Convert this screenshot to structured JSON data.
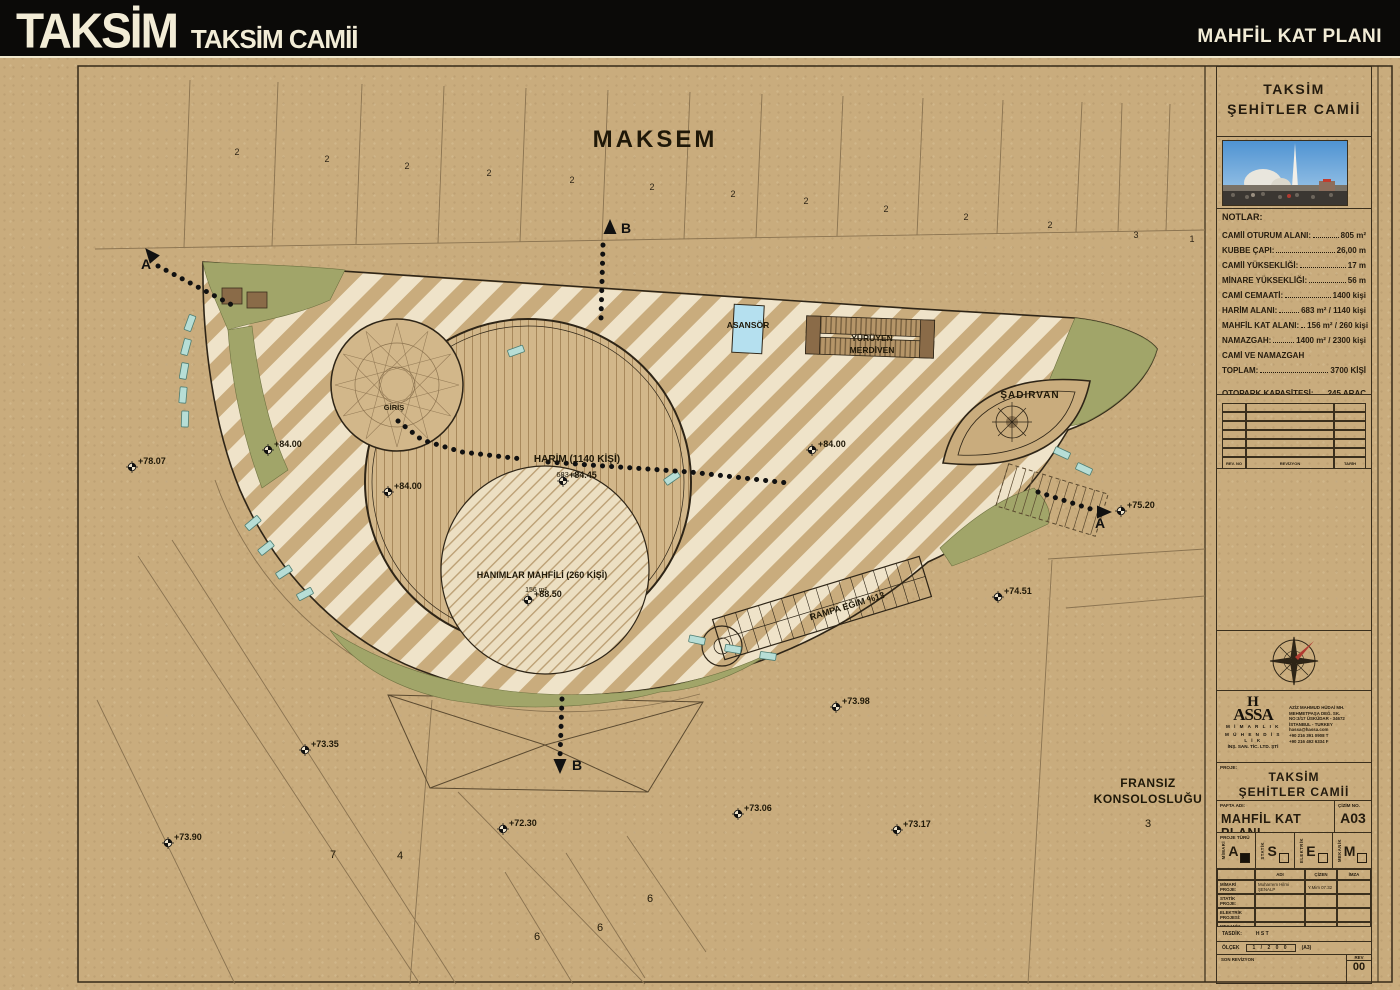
{
  "header": {
    "logo": "TAKSİM",
    "logo_sub": "TAKSİM CAMİİ",
    "sheet_title": "MAHFİL KAT PLANI"
  },
  "plan": {
    "labels": [
      {
        "t": "MAKSEM",
        "x": 655,
        "y": 147,
        "s": 24,
        "w": 600,
        "ls": 3
      },
      {
        "t": "ASANSÖR",
        "x": 748,
        "y": 328,
        "s": 8.5,
        "w": 700
      },
      {
        "t": "YÜRÜYEN",
        "x": 872,
        "y": 341,
        "s": 8.5,
        "w": 700
      },
      {
        "t": "MERDİVEN",
        "x": 872,
        "y": 353,
        "s": 8.5,
        "w": 700
      },
      {
        "t": "ŞADIRVAN",
        "x": 1030,
        "y": 398,
        "s": 10,
        "w": 700,
        "ls": 1
      },
      {
        "t": "GİRİŞ",
        "x": 394,
        "y": 410,
        "s": 7.5,
        "w": 700
      },
      {
        "t": "HARİM (1140 KİŞİ)",
        "x": 577,
        "y": 462,
        "s": 10,
        "w": 700
      },
      {
        "t": "683 m²",
        "x": 568,
        "y": 477,
        "s": 7.5,
        "w": 400
      },
      {
        "t": "HANIMLAR MAHFİLİ (260 KİŞİ)",
        "x": 542,
        "y": 578,
        "s": 9,
        "w": 700
      },
      {
        "t": "156 m²",
        "x": 536,
        "y": 592,
        "s": 7,
        "w": 400
      },
      {
        "t": "RAMPA EĞİM %13",
        "x": 848,
        "y": 609,
        "s": 9,
        "w": 700,
        "r": -17
      },
      {
        "t": "FRANSIZ",
        "x": 1148,
        "y": 787,
        "s": 12,
        "w": 600,
        "ls": 0.5
      },
      {
        "t": "KONSOLOSLUĞU",
        "x": 1148,
        "y": 803,
        "s": 12,
        "w": 600,
        "ls": 0.5
      },
      {
        "t": "3",
        "x": 1148,
        "y": 827,
        "s": 11,
        "w": 400
      },
      {
        "t": "7",
        "x": 333,
        "y": 858,
        "s": 11,
        "w": 400
      },
      {
        "t": "4",
        "x": 400,
        "y": 859,
        "s": 11,
        "w": 400
      },
      {
        "t": "6",
        "x": 537,
        "y": 940,
        "s": 11,
        "w": 400
      },
      {
        "t": "6",
        "x": 600,
        "y": 931,
        "s": 11,
        "w": 400
      },
      {
        "t": "6",
        "x": 650,
        "y": 902,
        "s": 11,
        "w": 400
      }
    ],
    "parcel_numbers": [
      {
        "t": "2",
        "x": 237,
        "y": 155
      },
      {
        "t": "2",
        "x": 327,
        "y": 162
      },
      {
        "t": "2",
        "x": 407,
        "y": 169
      },
      {
        "t": "2",
        "x": 489,
        "y": 176
      },
      {
        "t": "2",
        "x": 572,
        "y": 183
      },
      {
        "t": "2",
        "x": 652,
        "y": 190
      },
      {
        "t": "2",
        "x": 733,
        "y": 197
      },
      {
        "t": "2",
        "x": 806,
        "y": 204
      },
      {
        "t": "2",
        "x": 886,
        "y": 212
      },
      {
        "t": "2",
        "x": 966,
        "y": 220
      },
      {
        "t": "2",
        "x": 1050,
        "y": 228
      },
      {
        "t": "3",
        "x": 1136,
        "y": 238
      },
      {
        "t": "1",
        "x": 1192,
        "y": 242
      }
    ],
    "elevations": [
      {
        "x": 132,
        "y": 467,
        "v": "+78.07"
      },
      {
        "x": 268,
        "y": 450,
        "v": "+84.00"
      },
      {
        "x": 388,
        "y": 492,
        "v": "+84.00"
      },
      {
        "x": 563,
        "y": 481,
        "v": "+84.45"
      },
      {
        "x": 812,
        "y": 450,
        "v": "+84.00"
      },
      {
        "x": 528,
        "y": 600,
        "v": "+88.50"
      },
      {
        "x": 1121,
        "y": 511,
        "v": "+75.20"
      },
      {
        "x": 998,
        "y": 597,
        "v": "+74.51"
      },
      {
        "x": 836,
        "y": 707,
        "v": "+73.98"
      },
      {
        "x": 305,
        "y": 750,
        "v": "+73.35"
      },
      {
        "x": 168,
        "y": 843,
        "v": "+73.90"
      },
      {
        "x": 503,
        "y": 829,
        "v": "+72.30"
      },
      {
        "x": 738,
        "y": 814,
        "v": "+73.06"
      },
      {
        "x": 897,
        "y": 830,
        "v": "+73.17"
      }
    ],
    "sections": [
      {
        "l": "A",
        "x": 151,
        "y": 255,
        "a": -40,
        "lx": -10,
        "ly": 14
      },
      {
        "l": "B",
        "x": 610,
        "y": 228,
        "a": 0,
        "lx": 11,
        "ly": 5
      },
      {
        "l": "A",
        "x": 1103,
        "y": 512,
        "a": 90,
        "lx": -8,
        "ly": 16
      },
      {
        "l": "B",
        "x": 560,
        "y": 765,
        "a": 180,
        "lx": 12,
        "ly": 5
      }
    ],
    "dotted_paths": [
      [
        [
          158,
          266
        ],
        [
          232,
          305
        ]
      ],
      [
        [
          603,
          245
        ],
        [
          601,
          318
        ]
      ],
      [
        [
          398,
          421
        ],
        [
          422,
          440
        ],
        [
          462,
          452
        ],
        [
          522,
          459
        ]
      ],
      [
        [
          548,
          462
        ],
        [
          690,
          472
        ],
        [
          788,
          483
        ]
      ],
      [
        [
          562,
          699
        ],
        [
          560,
          757
        ]
      ],
      [
        [
          1038,
          492
        ],
        [
          1097,
          511
        ]
      ]
    ],
    "benches": [
      [
        190,
        323,
        -70
      ],
      [
        186,
        347,
        -75
      ],
      [
        184,
        371,
        -80
      ],
      [
        183,
        395,
        -85
      ],
      [
        185,
        419,
        -88
      ],
      [
        253,
        523,
        -40
      ],
      [
        266,
        548,
        -38
      ],
      [
        284,
        572,
        -33
      ],
      [
        305,
        594,
        -28
      ],
      [
        697,
        640,
        12
      ],
      [
        733,
        649,
        10
      ],
      [
        768,
        656,
        8
      ],
      [
        1062,
        453,
        25
      ],
      [
        1084,
        469,
        25
      ],
      [
        516,
        351,
        -20
      ],
      [
        672,
        478,
        -35
      ]
    ]
  },
  "sidebar": {
    "project_title": [
      "TAKSİM",
      "ŞEHİTLER CAMİİ"
    ],
    "notes_title": "NOTLAR:",
    "notes": [
      {
        "label": "CAMİİ OTURUM ALANI:",
        "value": "805 m²"
      },
      {
        "label": "KUBBE ÇAPI:",
        "value": "26,00 m"
      },
      {
        "label": "CAMİİ YÜKSEKLİĞİ:",
        "value": "17 m"
      },
      {
        "label": "MİNARE YÜKSEKLİĞİ:",
        "value": "56 m"
      },
      {
        "label": "CAMİ CEMAATİ:",
        "value": "1400 kişi"
      },
      {
        "label": "HARİM ALANI:",
        "value": "683 m² / 1140 kişi"
      },
      {
        "label": "MAHFİL KAT ALANI:",
        "value": "156 m² / 260 kişi"
      },
      {
        "label": "NAMAZGAH:",
        "value": "1400 m² / 2300 kişi"
      },
      {
        "label": "CAMİ VE NAMAZGAH",
        "label2": "TOPLAM:",
        "value": "3700 KİŞİ"
      },
      {
        "label": "OTOPARK KAPASİTESİ:",
        "value": "245 ARAÇ",
        "gap": true
      }
    ],
    "revision_table": {
      "headers": [
        "REV. NO",
        "REVİZYON",
        "TARİH"
      ],
      "empty_rows": 6
    },
    "firm": {
      "name_top": "H",
      "name_bottom": "ASSA",
      "lines": [
        "M İ M A R L I K",
        "M Ü H E N D İ S L İ K",
        "İNŞ. SAN. TİC. LTD. ŞTİ"
      ],
      "address": [
        "AZİZ MAHMUD HÜDAİ MH.",
        "MEHMETPAŞA DEĞ. SK.",
        "NO:3/17 ÜSKÜDAR - 34672",
        "İSTANBUL - TURKEY",
        "hassa@hassa.com",
        "+90 216 391 0908 T",
        "+90 216 492 6334 F"
      ]
    },
    "project_label": "PROJE:",
    "sheet": {
      "pafta_label": "PAFTA ADI:",
      "pafta_name": "MAHFİL KAT PLANI",
      "no_label": "ÇİZİM NO.",
      "no": "A03"
    },
    "types_label": "PROJE TÜRÜ",
    "types": [
      {
        "letter": "A",
        "name": "MİMARİ",
        "checked": true
      },
      {
        "letter": "S",
        "name": "STATİK",
        "checked": false
      },
      {
        "letter": "E",
        "name": "ELEKTRİK",
        "checked": false
      },
      {
        "letter": "M",
        "name": "MEKANİK",
        "checked": false
      }
    ],
    "staff": {
      "headers": [
        "",
        "ADI",
        "ÇİZEN",
        "İMZA"
      ],
      "rows": [
        {
          "label": "MİMARİ PROJE:",
          "name": "Muharrem Hilmi ŞENALP",
          "extra": "Y.Mim 07.32"
        },
        {
          "label": "STATİK PROJE:",
          "name": "",
          "extra": ""
        },
        {
          "label": "ELEKTRİK PROJESİ:",
          "name": "",
          "extra": ""
        },
        {
          "label": "MEKANİK PROJE:",
          "name": "",
          "extra": ""
        }
      ]
    },
    "tasdik_label": "TASDİK:",
    "tasdik_value": "H S T",
    "scale_label": "ÖLÇEK",
    "scale_value": "1 / 2 0 0",
    "scale_extra": "(A3)",
    "last_rev_label": "SON REVİZYON",
    "rev_label": "REV",
    "rev_no": "00"
  }
}
